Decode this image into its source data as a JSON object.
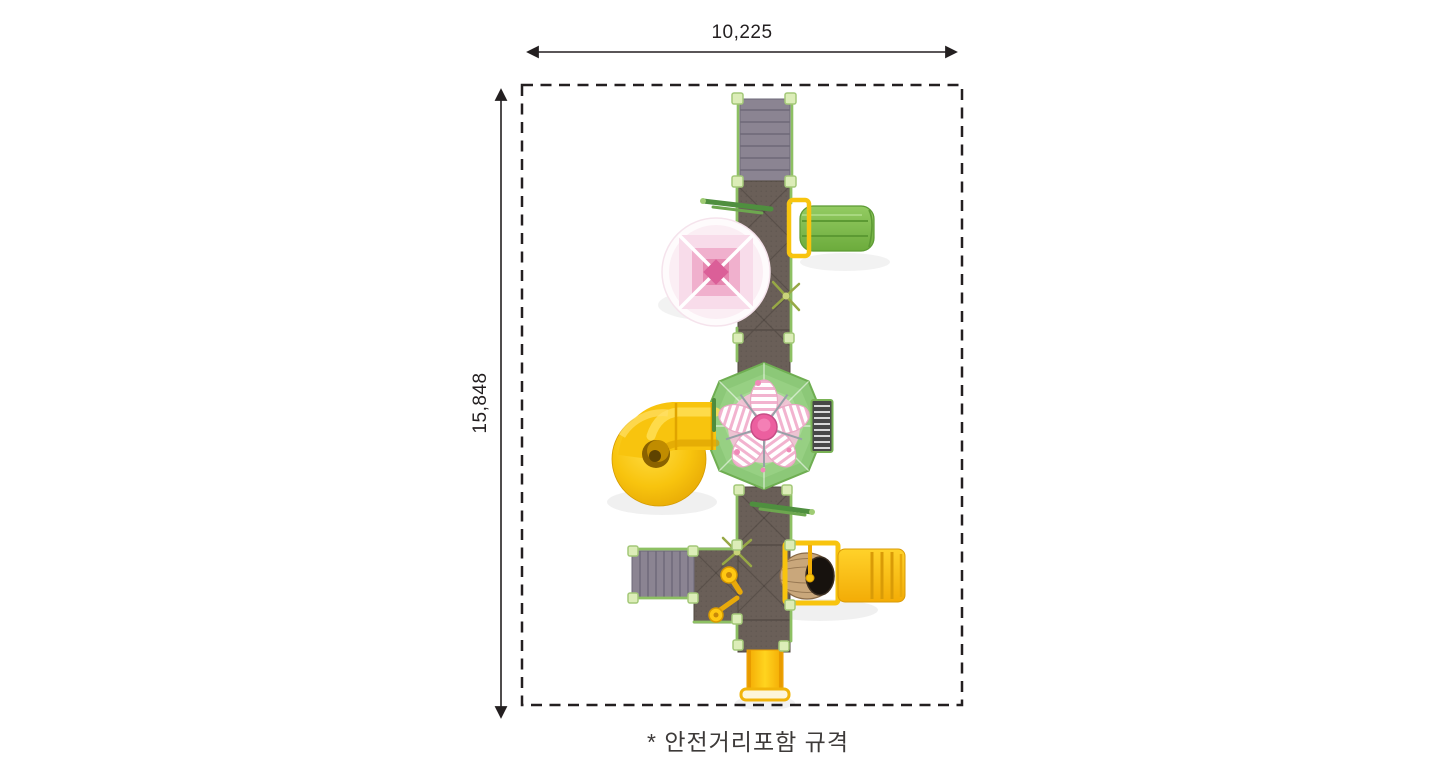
{
  "labels": {
    "width": "10,225",
    "height": "15,848",
    "caption": "* 안전거리포함 규격"
  },
  "colors": {
    "line": "#231f20",
    "deck": "#6a5f58",
    "deck_edge": "#50483f",
    "stairs": "#8b8492",
    "stair_line": "#6e6878",
    "post": "#dcedb8",
    "post_edge": "#a3c878",
    "rail": "#8dc063",
    "roof": "#8cc878",
    "roof_ring2": "#97d083",
    "roof_ring3": "#a6d994",
    "roof_ring4": "#b7e2a6",
    "slide_green": "#7db54e",
    "yellow": "#f8c40e",
    "yellow_deep": "#e3a303",
    "flower_pink": "#ec5f9f",
    "canopy_light": "#f8dcea",
    "canopy_mid": "#f0b0cd",
    "canopy_deep": "#db5f98",
    "barrel_wood": "#c9a77b",
    "ladder_dark": "#474747"
  }
}
